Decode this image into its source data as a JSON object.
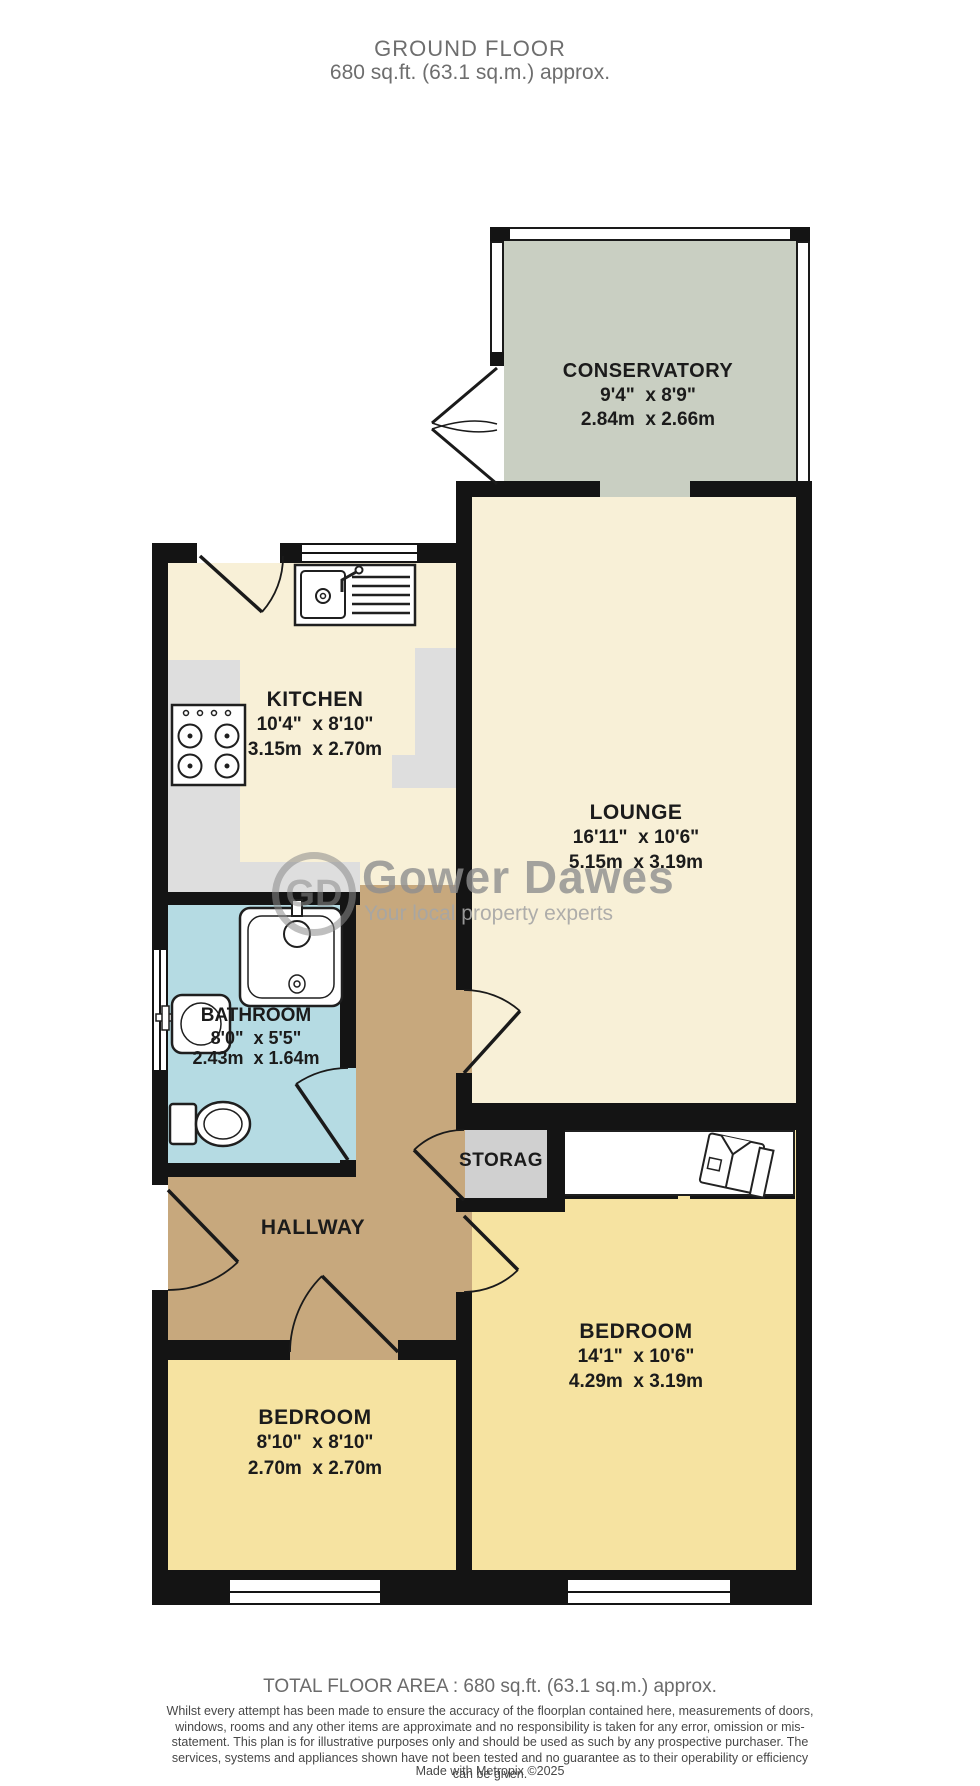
{
  "header": {
    "title": "GROUND FLOOR",
    "subtitle": "680 sq.ft. (63.1 sq.m.) approx."
  },
  "rooms": {
    "conservatory": {
      "name": "CONSERVATORY",
      "imperial": "9'4\"  x 8'9\"",
      "metric": "2.84m  x 2.66m"
    },
    "kitchen": {
      "name": "KITCHEN",
      "imperial": "10'4\"  x 8'10\"",
      "metric": "3.15m  x 2.70m"
    },
    "lounge": {
      "name": "LOUNGE",
      "imperial": "16'11\"  x 10'6\"",
      "metric": "5.15m  x 3.19m"
    },
    "bathroom": {
      "name": "BATHROOM",
      "imperial": "8'0\"  x 5'5\"",
      "metric": "2.43m  x 1.64m"
    },
    "hallway": {
      "name": "HALLWAY"
    },
    "storage": {
      "name": "STORAG"
    },
    "bedroom_right": {
      "name": "BEDROOM",
      "imperial": "14'1\"  x 10'6\"",
      "metric": "4.29m  x 3.19m"
    },
    "bedroom_left": {
      "name": "BEDROOM",
      "imperial": "8'10\"  x 8'10\"",
      "metric": "2.70m  x 2.70m"
    }
  },
  "watermark": {
    "initials": "GD",
    "name": "Gower Dawes",
    "tagline": "Your local property experts"
  },
  "footer": {
    "total_area": "TOTAL FLOOR AREA : 680 sq.ft. (63.1 sq.m.) approx.",
    "disclaimer": "Whilst every attempt has been made to ensure the accuracy of the floorplan contained here, measurements of doors, windows, rooms and any other items are approximate and no responsibility is taken for any error, omission or mis-statement. This plan is for illustrative purposes only and should be used as such by any prospective purchaser. The services, systems and appliances shown have not been tested and no guarantee as to their operability or efficiency can be given.",
    "credit": "Made with Metropix ©2025"
  },
  "colors": {
    "wall": "#141414",
    "kitchen_lounge_floor": "#f8f0d7",
    "conservatory_floor": "#c9cfc2",
    "bathroom_floor": "#b5dbe3",
    "hallway_floor": "#c7a87d",
    "bedroom_floor": "#f6e3a1",
    "storage_floor": "#d0d0d0",
    "counter_gray": "#dedede",
    "title_gray": "#6e6e6e",
    "label_black": "#1b1b1b"
  }
}
